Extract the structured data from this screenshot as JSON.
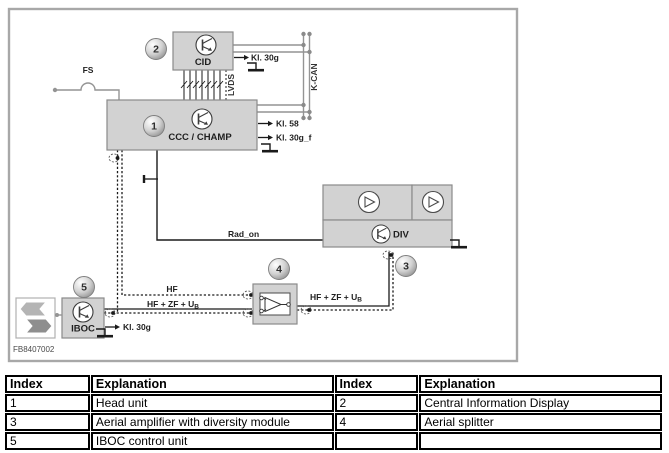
{
  "colors": {
    "block_fill": "#d2d2d2",
    "block_border": "#8a8a8a",
    "gray_wire": "#949494",
    "black_wire": "#1a1a1a",
    "frame_border": "#a8a8a8"
  },
  "diagram": {
    "figure_id": "FB8407002",
    "blocks": {
      "cid": "CID",
      "ccc_champ": "CCC / CHAMP",
      "div": "DIV",
      "iboc": "IBOC"
    },
    "badges": {
      "head_unit": "1",
      "cid": "2",
      "diversity": "3",
      "splitter": "4",
      "iboc": "5"
    },
    "labels": {
      "fs": "FS",
      "k_can": "K-CAN",
      "lvds": "LVDS",
      "kl_30g_cid": "Kl. 30g",
      "kl_58": "Kl. 58",
      "kl_30g_f": "Kl. 30g_f",
      "kl_30g_iboc": "Kl. 30g",
      "rad_on": "Rad_on",
      "hf": "HF",
      "hf_zf_u_main": "HF + ZF + U",
      "hf_zf_u_sub": "B"
    }
  },
  "table": {
    "headers": [
      "Index",
      "Explanation",
      "Index",
      "Explanation"
    ],
    "rows": [
      [
        "1",
        "Head unit",
        "2",
        "Central Information Display"
      ],
      [
        "3",
        "Aerial amplifier with diversity module",
        "4",
        "Aerial splitter"
      ],
      [
        "5",
        "IBOC control unit",
        "",
        ""
      ]
    ]
  }
}
